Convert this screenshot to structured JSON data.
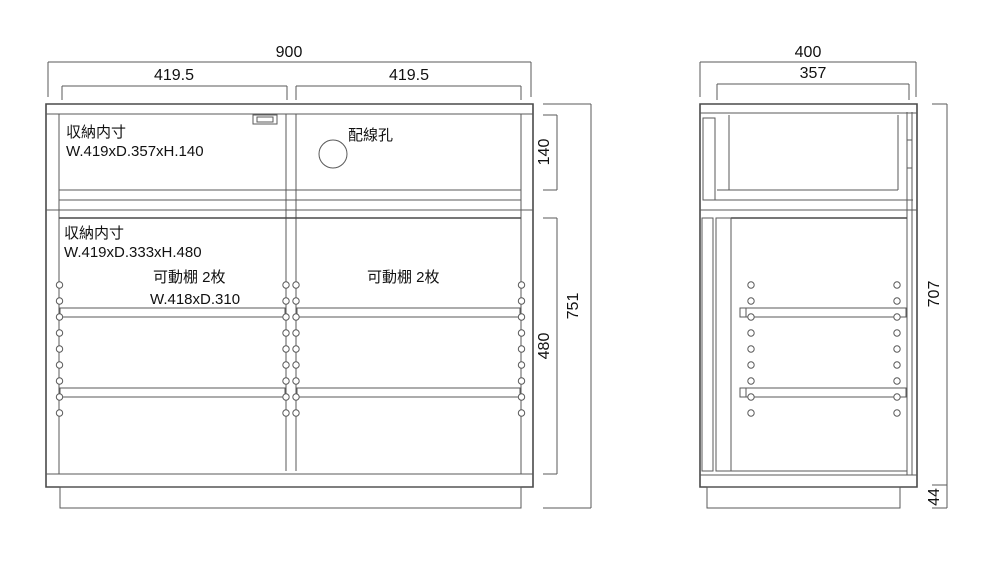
{
  "drawing": {
    "front_view": {
      "dims": {
        "overall_width": "900",
        "left_section_width": "419.5",
        "right_section_width": "419.5",
        "top_inner_height": "140",
        "bottom_inner_height": "480",
        "overall_height": "751"
      },
      "top_storage": {
        "title": "収納内寸",
        "size": "W.419xD.357xH.140"
      },
      "wiring_hole_label": "配線孔",
      "bottom_storage": {
        "title": "収納内寸",
        "size": "W.419xD.333xH.480"
      },
      "left_shelf": {
        "label": "可動棚 2枚",
        "size": "W.418xD.310"
      },
      "right_shelf": {
        "label": "可動棚 2枚"
      }
    },
    "side_view": {
      "dims": {
        "overall_depth": "400",
        "inner_depth": "357",
        "body_height": "707",
        "base_height": "44"
      }
    },
    "colors": {
      "line": "#5a5a5a",
      "text": "#111111",
      "background": "#ffffff"
    }
  }
}
